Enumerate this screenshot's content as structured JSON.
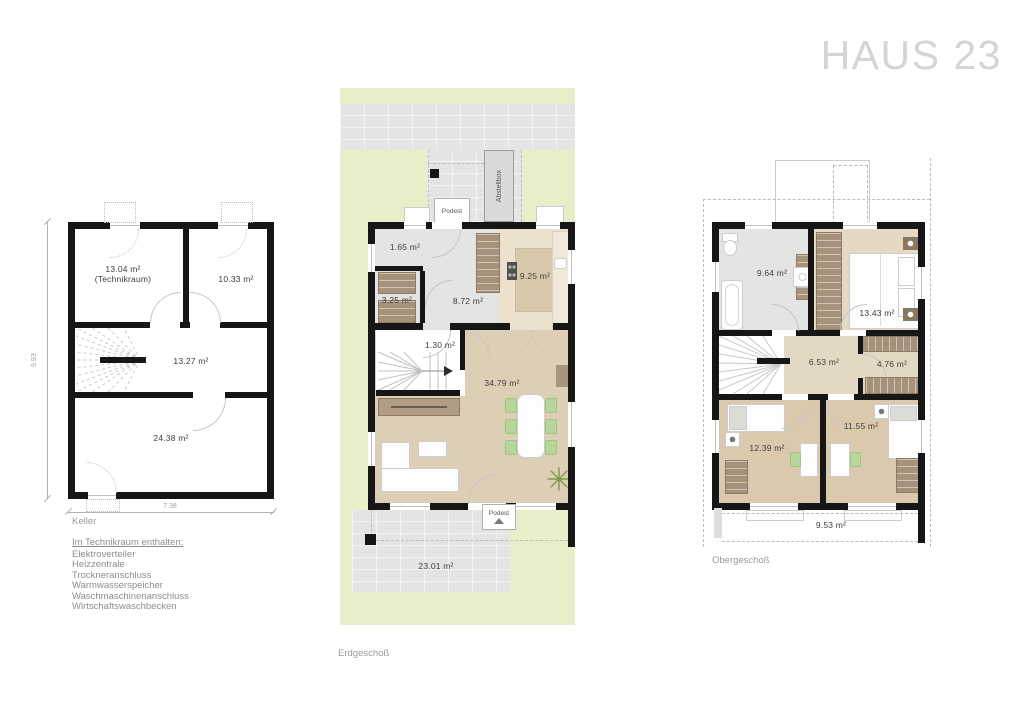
{
  "title": "HAUS 23",
  "colors": {
    "garden": "#e9edc8",
    "paving": "#e4e4e4",
    "wood_floor": "#dccfb6",
    "furniture_brown": "#a6927a",
    "chair_green": "#b9d69a",
    "wall": "#161616",
    "title_grey": "#d5d5d5"
  },
  "keller": {
    "floor_label": "Keller",
    "dimensions": {
      "width": "7.38",
      "height": "9.93"
    },
    "rooms": {
      "technikraum": "13.04 m²\n(Technikraum)",
      "kellerraum": "10.33 m²",
      "flur": "13.27 m²",
      "hobbyraum": "24.38 m²"
    },
    "notes": {
      "heading": "Im Technikraum enthalten:",
      "items": [
        "Elektroverteiler",
        "Heizzentrale",
        "Trockneranschluss",
        "Warmwasserspeicher",
        "Waschmaschinenanschluss",
        "Wirtschaftswaschbecken"
      ]
    }
  },
  "erdgeschoss": {
    "floor_label": "Erdgeschoß",
    "labels": {
      "podest_top": "Podest",
      "podest_bottom": "Podest",
      "abstellbox": "Abstellbox"
    },
    "rooms": {
      "wc": "1.65 m²",
      "garderobe": "3.25 m²",
      "diele": "8.72 m²",
      "kueche": "9.25 m²",
      "abstellraum": "1.30 m²",
      "wohnen_essen": "34.79 m²",
      "terrasse": "23.01 m²"
    }
  },
  "obergeschoss": {
    "floor_label": "Obergeschoß",
    "rooms": {
      "bad": "9.64 m²",
      "schlafen": "13.43 m²",
      "flur": "6.53 m²",
      "ankleide": "4.76 m²",
      "kind_1": "12.39 m²",
      "kind_2": "11.55 m²",
      "balkon": "9.53 m²"
    }
  }
}
